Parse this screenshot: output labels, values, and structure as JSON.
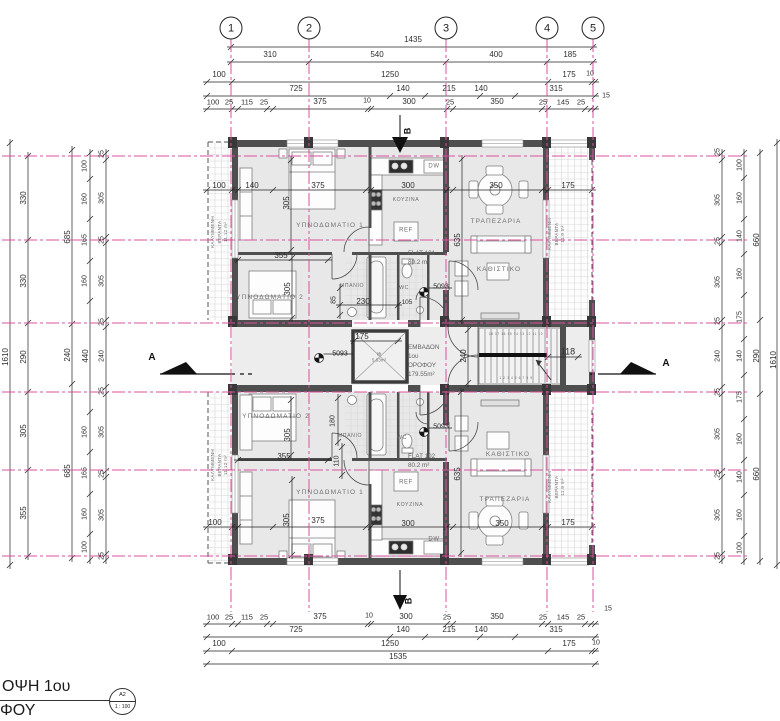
{
  "colors": {
    "grid_pink": "#d8509c",
    "wall_gray": "#4f4f4f",
    "room_fill": "#e8e8e8",
    "line_black": "#222222"
  },
  "title": {
    "line1": "ΟΨΗ 1ου",
    "line2": "ΦΟΥ",
    "sheet_ref": "A2",
    "scale": "1 : 100"
  },
  "grid_bubbles": [
    {
      "n": "1",
      "x": 231
    },
    {
      "n": "2",
      "x": 309
    },
    {
      "n": "3",
      "x": 446
    },
    {
      "n": "4",
      "x": 547
    },
    {
      "n": "5",
      "x": 593
    }
  ],
  "plan_info": {
    "floor_area_note": "ΕΜΒΑΔΟΝ 1ου ΟΡΟΦΟΥ 179.55m²",
    "flats": [
      "FLAT 101 80.2 m²",
      "FLAT 102 80.2 m²"
    ],
    "lift_area": "5.63m²",
    "verandas": [
      "11.12 m²",
      "11.9 m²"
    ]
  },
  "labels": [
    {
      "t": "1435",
      "x": 413,
      "y": 40,
      "k": "dh"
    },
    {
      "t": "310",
      "x": 270,
      "y": 55,
      "k": "dh"
    },
    {
      "t": "540",
      "x": 377,
      "y": 55,
      "k": "dh"
    },
    {
      "t": "400",
      "x": 496,
      "y": 55,
      "k": "dh"
    },
    {
      "t": "185",
      "x": 570,
      "y": 55,
      "k": "dh"
    },
    {
      "t": "100",
      "x": 219,
      "y": 75,
      "k": "dh"
    },
    {
      "t": "1250",
      "x": 390,
      "y": 75,
      "k": "dh"
    },
    {
      "t": "175",
      "x": 569,
      "y": 75,
      "k": "dh"
    },
    {
      "t": "10",
      "x": 590,
      "y": 75,
      "k": "dh",
      "s": 7
    },
    {
      "t": "725",
      "x": 296,
      "y": 89,
      "k": "dh"
    },
    {
      "t": "140",
      "x": 403,
      "y": 89,
      "k": "dh"
    },
    {
      "t": "215",
      "x": 449,
      "y": 89,
      "k": "dh"
    },
    {
      "t": "140",
      "x": 481,
      "y": 89,
      "k": "dh"
    },
    {
      "t": "315",
      "x": 556,
      "y": 89,
      "k": "dh"
    },
    {
      "t": "15",
      "x": 606,
      "y": 97,
      "k": "dh",
      "s": 7
    },
    {
      "t": "100",
      "x": 213,
      "y": 102,
      "k": "dh",
      "s": 7.5
    },
    {
      "t": "25",
      "x": 229,
      "y": 102,
      "k": "dh",
      "s": 7.5
    },
    {
      "t": "115",
      "x": 247,
      "y": 102,
      "k": "dh",
      "s": 7.5
    },
    {
      "t": "25",
      "x": 264,
      "y": 102,
      "k": "dh",
      "s": 7.5
    },
    {
      "t": "375",
      "x": 320,
      "y": 102,
      "k": "dh"
    },
    {
      "t": "10",
      "x": 367,
      "y": 102,
      "k": "dh",
      "s": 7
    },
    {
      "t": "300",
      "x": 409,
      "y": 102,
      "k": "dh"
    },
    {
      "t": "25",
      "x": 450,
      "y": 102,
      "k": "dh",
      "s": 7.5
    },
    {
      "t": "350",
      "x": 497,
      "y": 102,
      "k": "dh"
    },
    {
      "t": "25",
      "x": 543,
      "y": 102,
      "k": "dh",
      "s": 7.5
    },
    {
      "t": "145",
      "x": 563,
      "y": 102,
      "k": "dh",
      "s": 7.5
    },
    {
      "t": "25",
      "x": 581,
      "y": 102,
      "k": "dh",
      "s": 7.5
    },
    {
      "t": "100",
      "x": 213,
      "y": 617,
      "k": "dh",
      "s": 7.5
    },
    {
      "t": "25",
      "x": 229,
      "y": 617,
      "k": "dh",
      "s": 7.5
    },
    {
      "t": "115",
      "x": 247,
      "y": 617,
      "k": "dh",
      "s": 7.5
    },
    {
      "t": "25",
      "x": 264,
      "y": 617,
      "k": "dh",
      "s": 7.5
    },
    {
      "t": "375",
      "x": 320,
      "y": 617,
      "k": "dh"
    },
    {
      "t": "10",
      "x": 369,
      "y": 617,
      "k": "dh",
      "s": 7
    },
    {
      "t": "300",
      "x": 406,
      "y": 617,
      "k": "dh"
    },
    {
      "t": "25",
      "x": 447,
      "y": 617,
      "k": "dh",
      "s": 7.5
    },
    {
      "t": "350",
      "x": 497,
      "y": 617,
      "k": "dh"
    },
    {
      "t": "25",
      "x": 543,
      "y": 617,
      "k": "dh",
      "s": 7.5
    },
    {
      "t": "145",
      "x": 563,
      "y": 617,
      "k": "dh",
      "s": 7.5
    },
    {
      "t": "25",
      "x": 581,
      "y": 617,
      "k": "dh",
      "s": 7.5
    },
    {
      "t": "15",
      "x": 608,
      "y": 610,
      "k": "dh",
      "s": 7
    },
    {
      "t": "725",
      "x": 296,
      "y": 630,
      "k": "dh"
    },
    {
      "t": "140",
      "x": 403,
      "y": 630,
      "k": "dh"
    },
    {
      "t": "215",
      "x": 449,
      "y": 630,
      "k": "dh"
    },
    {
      "t": "140",
      "x": 481,
      "y": 630,
      "k": "dh"
    },
    {
      "t": "315",
      "x": 556,
      "y": 630,
      "k": "dh"
    },
    {
      "t": "100",
      "x": 219,
      "y": 644,
      "k": "dh"
    },
    {
      "t": "1250",
      "x": 390,
      "y": 644,
      "k": "dh"
    },
    {
      "t": "175",
      "x": 569,
      "y": 644,
      "k": "dh"
    },
    {
      "t": "10",
      "x": 596,
      "y": 644,
      "k": "dh",
      "s": 7
    },
    {
      "t": "1535",
      "x": 398,
      "y": 657,
      "k": "dh"
    },
    {
      "t": "1610",
      "x": 6,
      "y": 357,
      "k": "dv"
    },
    {
      "t": "330",
      "x": 24,
      "y": 198,
      "k": "dv"
    },
    {
      "t": "330",
      "x": 24,
      "y": 281,
      "k": "dv"
    },
    {
      "t": "290",
      "x": 24,
      "y": 357,
      "k": "dv"
    },
    {
      "t": "305",
      "x": 24,
      "y": 431,
      "k": "dv"
    },
    {
      "t": "355",
      "x": 24,
      "y": 513,
      "k": "dv"
    },
    {
      "t": "685",
      "x": 68,
      "y": 237,
      "k": "dv"
    },
    {
      "t": "240",
      "x": 68,
      "y": 355,
      "k": "dv"
    },
    {
      "t": "685",
      "x": 68,
      "y": 471,
      "k": "dv"
    },
    {
      "t": "100",
      "x": 86,
      "y": 166,
      "k": "dv",
      "s": 7
    },
    {
      "t": "160",
      "x": 86,
      "y": 199,
      "k": "dv",
      "s": 7
    },
    {
      "t": "165",
      "x": 86,
      "y": 240,
      "k": "dv",
      "s": 7
    },
    {
      "t": "160",
      "x": 86,
      "y": 281,
      "k": "dv",
      "s": 7
    },
    {
      "t": "440",
      "x": 86,
      "y": 356,
      "k": "dv"
    },
    {
      "t": "160",
      "x": 86,
      "y": 432,
      "k": "dv",
      "s": 7
    },
    {
      "t": "165",
      "x": 86,
      "y": 473,
      "k": "dv",
      "s": 7
    },
    {
      "t": "160",
      "x": 86,
      "y": 514,
      "k": "dv",
      "s": 7
    },
    {
      "t": "100",
      "x": 86,
      "y": 547,
      "k": "dv",
      "s": 7
    },
    {
      "t": "25",
      "x": 103,
      "y": 154,
      "k": "dv",
      "s": 7
    },
    {
      "t": "305",
      "x": 103,
      "y": 198,
      "k": "dv",
      "s": 7
    },
    {
      "t": "25",
      "x": 103,
      "y": 240,
      "k": "dv",
      "s": 7
    },
    {
      "t": "305",
      "x": 103,
      "y": 281,
      "k": "dv",
      "s": 7
    },
    {
      "t": "25",
      "x": 103,
      "y": 322,
      "k": "dv",
      "s": 7
    },
    {
      "t": "240",
      "x": 103,
      "y": 356,
      "k": "dv",
      "s": 7
    },
    {
      "t": "25",
      "x": 103,
      "y": 391,
      "k": "dv",
      "s": 7
    },
    {
      "t": "305",
      "x": 103,
      "y": 432,
      "k": "dv",
      "s": 7
    },
    {
      "t": "25",
      "x": 103,
      "y": 474,
      "k": "dv",
      "s": 7
    },
    {
      "t": "305",
      "x": 103,
      "y": 515,
      "k": "dv",
      "s": 7
    },
    {
      "t": "25",
      "x": 103,
      "y": 556,
      "k": "dv",
      "s": 7
    },
    {
      "t": "25",
      "x": 719,
      "y": 152,
      "k": "dv",
      "s": 7
    },
    {
      "t": "305",
      "x": 719,
      "y": 200,
      "k": "dv",
      "s": 7
    },
    {
      "t": "25",
      "x": 719,
      "y": 241,
      "k": "dv",
      "s": 7
    },
    {
      "t": "305",
      "x": 719,
      "y": 282,
      "k": "dv",
      "s": 7
    },
    {
      "t": "25",
      "x": 719,
      "y": 321,
      "k": "dv",
      "s": 7
    },
    {
      "t": "240",
      "x": 719,
      "y": 356,
      "k": "dv",
      "s": 7
    },
    {
      "t": "25",
      "x": 719,
      "y": 392,
      "k": "dv",
      "s": 7
    },
    {
      "t": "305",
      "x": 719,
      "y": 434,
      "k": "dv",
      "s": 7
    },
    {
      "t": "25",
      "x": 719,
      "y": 474,
      "k": "dv",
      "s": 7
    },
    {
      "t": "305",
      "x": 719,
      "y": 515,
      "k": "dv",
      "s": 7
    },
    {
      "t": "25",
      "x": 719,
      "y": 556,
      "k": "dv",
      "s": 7
    },
    {
      "t": "100",
      "x": 741,
      "y": 165,
      "k": "dv",
      "s": 7
    },
    {
      "t": "160",
      "x": 741,
      "y": 198,
      "k": "dv",
      "s": 7
    },
    {
      "t": "140",
      "x": 741,
      "y": 236,
      "k": "dv",
      "s": 7
    },
    {
      "t": "160",
      "x": 741,
      "y": 274,
      "k": "dv",
      "s": 7
    },
    {
      "t": "175",
      "x": 741,
      "y": 317,
      "k": "dv",
      "s": 7
    },
    {
      "t": "140",
      "x": 741,
      "y": 356,
      "k": "dv",
      "s": 7
    },
    {
      "t": "175",
      "x": 741,
      "y": 397,
      "k": "dv",
      "s": 7
    },
    {
      "t": "160",
      "x": 741,
      "y": 439,
      "k": "dv",
      "s": 7
    },
    {
      "t": "140",
      "x": 741,
      "y": 477,
      "k": "dv",
      "s": 7
    },
    {
      "t": "160",
      "x": 741,
      "y": 515,
      "k": "dv",
      "s": 7
    },
    {
      "t": "100",
      "x": 741,
      "y": 548,
      "k": "dv",
      "s": 7
    },
    {
      "t": "660",
      "x": 757,
      "y": 240,
      "k": "dv"
    },
    {
      "t": "290",
      "x": 757,
      "y": 356,
      "k": "dv"
    },
    {
      "t": "660",
      "x": 757,
      "y": 474,
      "k": "dv"
    },
    {
      "t": "1610",
      "x": 774,
      "y": 360,
      "k": "dv"
    },
    {
      "t": "100",
      "x": 219,
      "y": 186,
      "k": "dh"
    },
    {
      "t": "140",
      "x": 252,
      "y": 186,
      "k": "dh"
    },
    {
      "t": "375",
      "x": 318,
      "y": 186,
      "k": "dh"
    },
    {
      "t": "300",
      "x": 408,
      "y": 186,
      "k": "dh"
    },
    {
      "t": "350",
      "x": 496,
      "y": 186,
      "k": "dh"
    },
    {
      "t": "175",
      "x": 568,
      "y": 186,
      "k": "dh"
    },
    {
      "t": "305",
      "x": 287,
      "y": 203,
      "k": "dv"
    },
    {
      "t": "355",
      "x": 281,
      "y": 256,
      "k": "dh"
    },
    {
      "t": "305",
      "x": 288,
      "y": 289,
      "k": "dv"
    },
    {
      "t": "230",
      "x": 363,
      "y": 302,
      "k": "dh"
    },
    {
      "t": "85",
      "x": 335,
      "y": 300,
      "k": "dv",
      "s": 7
    },
    {
      "t": "105",
      "x": 407,
      "y": 303,
      "k": "dh",
      "s": 6.5
    },
    {
      "t": "ΥΠΝΟΔΩΜΑΤΙΟ 1",
      "x": 330,
      "y": 226,
      "k": "rm"
    },
    {
      "t": "ΥΠΝΟΔΩΜΑΤΙΟ 2",
      "x": 270,
      "y": 298,
      "k": "rm"
    },
    {
      "t": "ΜΠΑΝΙΟ",
      "x": 352,
      "y": 286,
      "k": "tn"
    },
    {
      "t": "WC",
      "x": 404,
      "y": 288,
      "k": "tn"
    },
    {
      "t": "ΚΟΥΖΙΝΑ",
      "x": 406,
      "y": 200,
      "k": "tn"
    },
    {
      "t": "REF",
      "x": 406,
      "y": 231,
      "k": "tn",
      "s": 6
    },
    {
      "t": "DW",
      "x": 434,
      "y": 167,
      "k": "tn",
      "s": 6
    },
    {
      "t": "ΤΡΑΠΕΖΑΡΙΑ",
      "x": 496,
      "y": 222,
      "k": "rm"
    },
    {
      "t": "ΚΑΘΙΣΤΙΚΟ",
      "x": 499,
      "y": 270,
      "k": "rm"
    },
    {
      "t": "635",
      "x": 458,
      "y": 240,
      "k": "dv"
    },
    {
      "t": "FLAT 101|80.2 m²",
      "x": 408,
      "y": 258,
      "k": "bl"
    },
    {
      "t": "ΚΑΛΥΜΜΕΝΗ|ΒΕΡΑΝΤΑ|11.12 m²",
      "x": 220,
      "y": 232,
      "k": "vb"
    },
    {
      "t": "ΚΑΛΥΜΜΕΝΗ|ΒΕΡΑΝΤΑ|11.9 m²",
      "x": 557,
      "y": 234,
      "k": "vb"
    },
    {
      "t": "175",
      "x": 362,
      "y": 337,
      "k": "dh"
    },
    {
      "t": "lift|5.63m²",
      "x": 379,
      "y": 358,
      "k": "lf"
    },
    {
      "t": "ΕΜΒΑΔΟΝ|1ου|ΟΡΟΦΟΥ|179.55m²",
      "x": 408,
      "y": 361,
      "k": "bl"
    },
    {
      "t": "240",
      "x": 464,
      "y": 356,
      "k": "dv"
    },
    {
      "t": "118",
      "x": 568,
      "y": 352,
      "k": "dh",
      "s": 9
    },
    {
      "t": "5093",
      "x": 441,
      "y": 288,
      "k": "dh",
      "s": 7
    },
    {
      "t": "5093",
      "x": 340,
      "y": 355,
      "k": "dh",
      "s": 7
    },
    {
      "t": "5093",
      "x": 441,
      "y": 428,
      "k": "dh",
      "s": 7
    },
    {
      "t": "18 17 16 15 14 13 12 11 10",
      "x": 516,
      "y": 334,
      "k": "tn",
      "s": 3.2
    },
    {
      "t": "1 2 3 4 5 6 7 8 9",
      "x": 516,
      "y": 378,
      "k": "tn",
      "s": 3.2
    },
    {
      "t": "ΥΠΝΟΔΩΜΑΤΙΟ 2",
      "x": 276,
      "y": 417,
      "k": "rm"
    },
    {
      "t": "355",
      "x": 284,
      "y": 457,
      "k": "dh"
    },
    {
      "t": "305",
      "x": 288,
      "y": 435,
      "k": "dv"
    },
    {
      "t": "180",
      "x": 334,
      "y": 421,
      "k": "dv",
      "s": 7
    },
    {
      "t": "110",
      "x": 338,
      "y": 461,
      "k": "dv",
      "s": 7
    },
    {
      "t": "ΜΠΑΝΙΟ",
      "x": 350,
      "y": 436,
      "k": "tn"
    },
    {
      "t": "WC",
      "x": 402,
      "y": 438,
      "k": "tn"
    },
    {
      "t": "ΥΠΝΟΔΩΜΑΤΙΟ 1",
      "x": 330,
      "y": 493,
      "k": "rm"
    },
    {
      "t": "100",
      "x": 215,
      "y": 523,
      "k": "dh"
    },
    {
      "t": "375",
      "x": 318,
      "y": 521,
      "k": "dh"
    },
    {
      "t": "305",
      "x": 287,
      "y": 520,
      "k": "dv"
    },
    {
      "t": "ΚΟΥΖΙΝΑ",
      "x": 410,
      "y": 505,
      "k": "tn"
    },
    {
      "t": "REF",
      "x": 406,
      "y": 483,
      "k": "tn",
      "s": 6
    },
    {
      "t": "300",
      "x": 408,
      "y": 524,
      "k": "dh"
    },
    {
      "t": "DW",
      "x": 434,
      "y": 540,
      "k": "tn",
      "s": 6
    },
    {
      "t": "FLAT 102|80.2 m²",
      "x": 408,
      "y": 461,
      "k": "bl"
    },
    {
      "t": "ΚΑΘΙΣΤΙΚΟ",
      "x": 508,
      "y": 455,
      "k": "rm"
    },
    {
      "t": "ΤΡΑΠΕΖΑΡΙΑ",
      "x": 505,
      "y": 500,
      "k": "rm"
    },
    {
      "t": "350",
      "x": 502,
      "y": 524,
      "k": "dh"
    },
    {
      "t": "635",
      "x": 458,
      "y": 474,
      "k": "dv"
    },
    {
      "t": "175",
      "x": 568,
      "y": 523,
      "k": "dh"
    },
    {
      "t": "ΚΑΛΥΜΜΕΝΗ|ΒΕΡΑΝΤΑ|11.12 m²",
      "x": 220,
      "y": 465,
      "k": "vb"
    },
    {
      "t": "ΚΑΛΥΜΜΕΝΗ|ΒΕΡΑΝΤΑ|11.9 m²",
      "x": 557,
      "y": 487,
      "k": "vb"
    },
    {
      "t": "A",
      "x": 152,
      "y": 358,
      "k": "mk"
    },
    {
      "t": "A",
      "x": 666,
      "y": 364,
      "k": "mk"
    },
    {
      "t": "B",
      "x": 408,
      "y": 131,
      "k": "mkv"
    },
    {
      "t": "B",
      "x": 409,
      "y": 601,
      "k": "mkv"
    }
  ]
}
